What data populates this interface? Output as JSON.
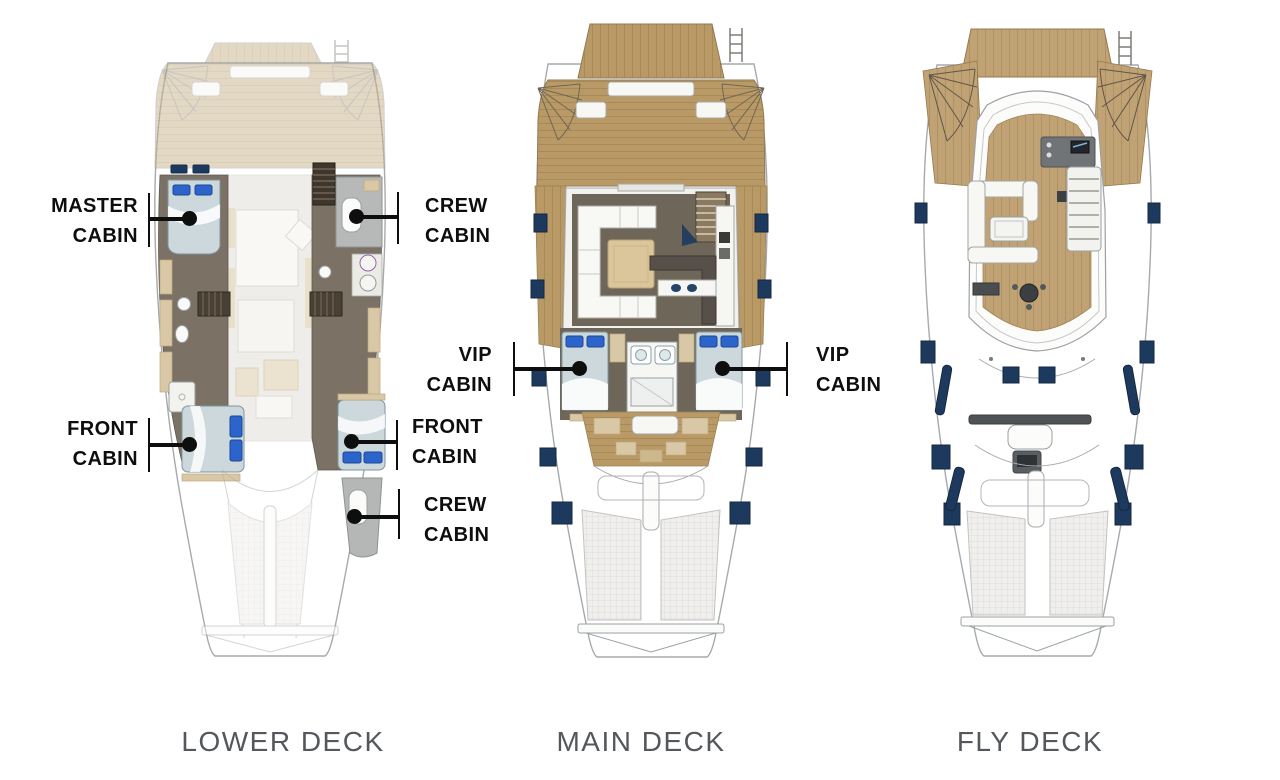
{
  "page": {
    "background": "#ffffff",
    "description": "Catamaran yacht layout plans, three decks top view"
  },
  "decks": {
    "lower": {
      "caption": "LOWER DECK"
    },
    "main": {
      "caption": "MAIN DECK"
    },
    "fly": {
      "caption": "FLY DECK"
    }
  },
  "annotations": {
    "master_cabin": {
      "line1": "MASTER",
      "line2": "CABIN"
    },
    "crew_cabin_top": {
      "line1": "CREW",
      "line2": "CABIN"
    },
    "front_cabin_left": {
      "line1": "FRONT",
      "line2": "CABIN"
    },
    "front_cabin_right": {
      "line1": "FRONT",
      "line2": "CABIN"
    },
    "crew_cabin_bottom": {
      "line1": "CREW",
      "line2": "CABIN"
    },
    "vip_cabin_left": {
      "line1": "VIP",
      "line2": "CABIN"
    },
    "vip_cabin_right": {
      "line1": "VIP",
      "line2": "CABIN"
    }
  },
  "colors": {
    "wood_main": "#b99a66",
    "wood_fly": "#c1a274",
    "wood_lower_faded": "#c9b28a",
    "interior_floor": "#6e6659",
    "bed": "#ccd8db",
    "pillow_blue": "#2b64ca",
    "hatch_navy": "#1d3a5e",
    "furniture_tan": "#d9c8a6",
    "crew_room_gray": "#b6b9b8",
    "hull_outline": "#a6aaad",
    "label_text": "#0e0e0e",
    "caption_text": "#54585c"
  }
}
